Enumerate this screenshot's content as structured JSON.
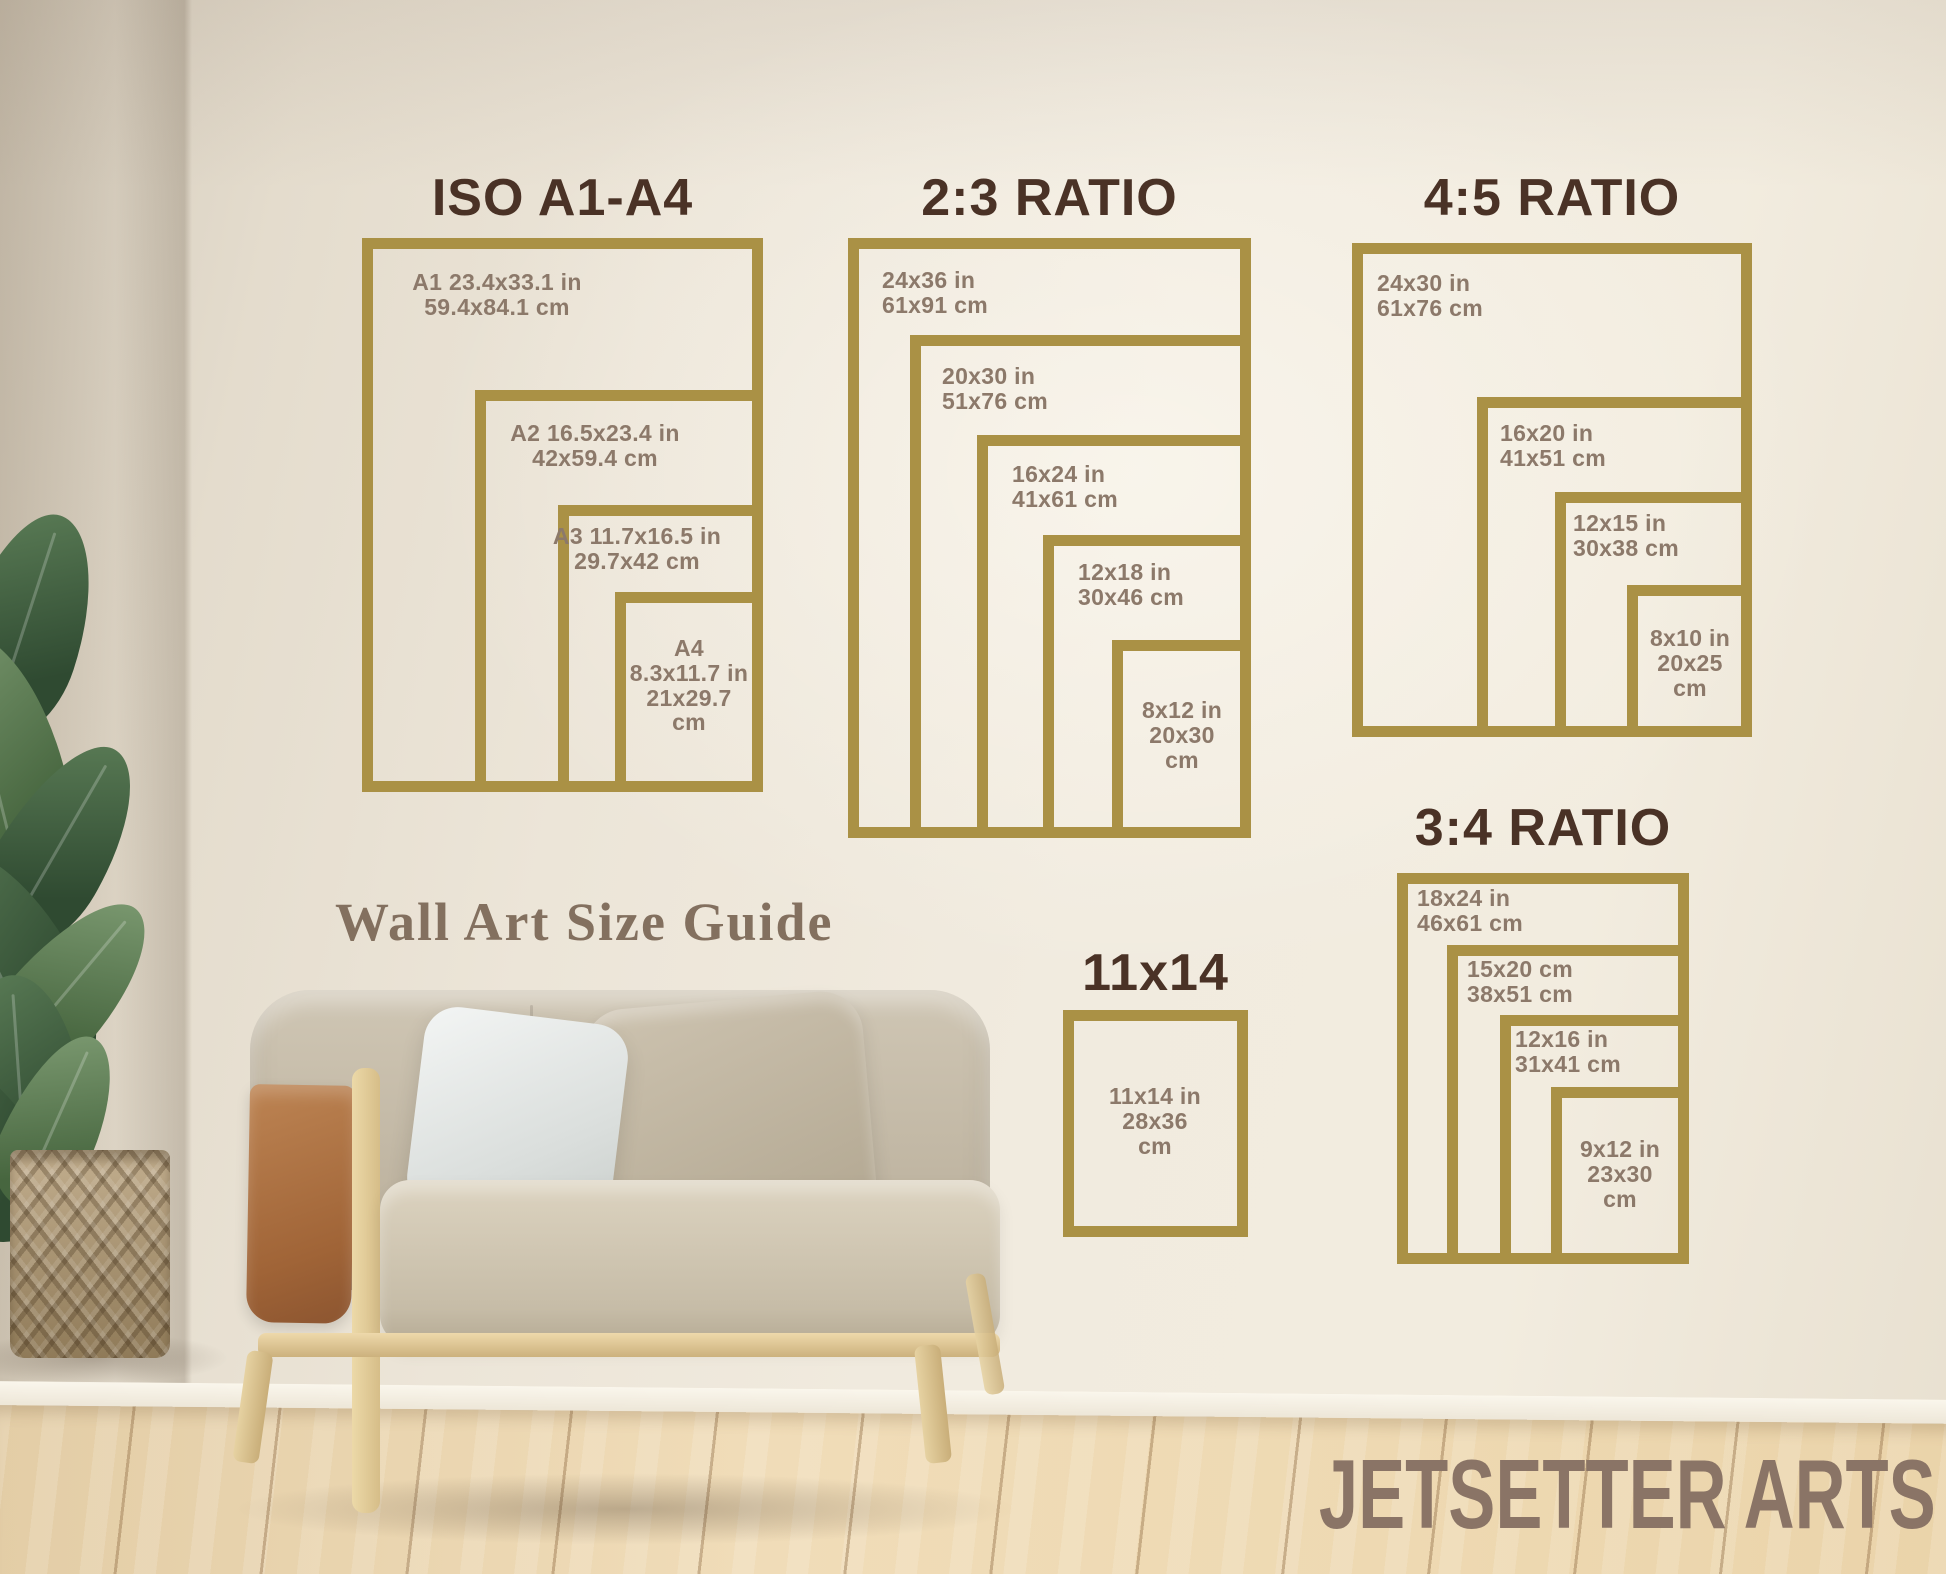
{
  "theme": {
    "frame_gold": "#aa9145",
    "title_brown": "#4a3226",
    "label_taupe": "#8c796a",
    "caption_color": "#83705f",
    "watermark_color": "#8a7466",
    "wall_color": "#ece5d8",
    "floor_wood": "#eed9b2"
  },
  "caption": "Wall Art Size Guide",
  "watermark": "JETSETTER ARTS",
  "groups": [
    {
      "id": "iso",
      "title": "ISO A1-A4",
      "title_y": 168,
      "frame": [
        362,
        238,
        763,
        792
      ],
      "sizes": [
        {
          "id": "a1",
          "lines": [
            "A1 23.4x33.1 in",
            "59.4x84.1 cm"
          ],
          "tl": [
            362,
            238
          ],
          "label": {
            "x": 497,
            "y": 270,
            "align": "center"
          }
        },
        {
          "id": "a2",
          "lines": [
            "A2 16.5x23.4 in",
            "42x59.4 cm"
          ],
          "tl": [
            475,
            390
          ],
          "label": {
            "x": 595,
            "y": 421,
            "align": "center"
          }
        },
        {
          "id": "a3",
          "lines": [
            "A3 11.7x16.5 in",
            "29.7x42 cm"
          ],
          "tl": [
            558,
            505
          ],
          "label": {
            "x": 637,
            "y": 524,
            "align": "center"
          }
        },
        {
          "id": "a4",
          "lines": [
            "A4",
            "8.3x11.7 in",
            "21x29.7",
            "cm"
          ],
          "tl": [
            615,
            592
          ],
          "label": {
            "x": 689,
            "y": 636,
            "align": "center"
          }
        }
      ]
    },
    {
      "id": "ratio-2-3",
      "title": "2:3 RATIO",
      "title_y": 168,
      "frame": [
        848,
        238,
        1251,
        838
      ],
      "sizes": [
        {
          "id": "24x36",
          "lines": [
            "24x36 in",
            "61x91 cm"
          ],
          "tl": [
            848,
            238
          ],
          "label": {
            "x": 882,
            "y": 268,
            "align": "left"
          }
        },
        {
          "id": "20x30",
          "lines": [
            "20x30 in",
            "51x76 cm"
          ],
          "tl": [
            910,
            335
          ],
          "label": {
            "x": 942,
            "y": 364,
            "align": "left"
          }
        },
        {
          "id": "16x24",
          "lines": [
            "16x24 in",
            "41x61 cm"
          ],
          "tl": [
            977,
            435
          ],
          "label": {
            "x": 1012,
            "y": 462,
            "align": "left"
          }
        },
        {
          "id": "12x18",
          "lines": [
            "12x18 in",
            "30x46 cm"
          ],
          "tl": [
            1043,
            535
          ],
          "label": {
            "x": 1078,
            "y": 560,
            "align": "left"
          }
        },
        {
          "id": "8x12",
          "lines": [
            "8x12 in",
            "20x30",
            "cm"
          ],
          "tl": [
            1112,
            640
          ],
          "label": {
            "x": 1182,
            "y": 698,
            "align": "center"
          }
        }
      ]
    },
    {
      "id": "ratio-4-5",
      "title": "4:5 RATIO",
      "title_y": 168,
      "frame": [
        1352,
        243,
        1752,
        737
      ],
      "sizes": [
        {
          "id": "24x30",
          "lines": [
            "24x30 in",
            "61x76 cm"
          ],
          "tl": [
            1352,
            243
          ],
          "label": {
            "x": 1377,
            "y": 271,
            "align": "left"
          }
        },
        {
          "id": "16x20",
          "lines": [
            "16x20 in",
            "41x51 cm"
          ],
          "tl": [
            1477,
            397
          ],
          "label": {
            "x": 1500,
            "y": 421,
            "align": "left"
          }
        },
        {
          "id": "12x15",
          "lines": [
            "12x15 in",
            "30x38 cm"
          ],
          "tl": [
            1555,
            492
          ],
          "label": {
            "x": 1573,
            "y": 511,
            "align": "left"
          }
        },
        {
          "id": "8x10",
          "lines": [
            "8x10 in",
            "20x25",
            "cm"
          ],
          "tl": [
            1627,
            585
          ],
          "label": {
            "x": 1690,
            "y": 626,
            "align": "center"
          }
        }
      ]
    },
    {
      "id": "ratio-3-4",
      "title": "3:4 RATIO",
      "title_y": 798,
      "frame": [
        1397,
        873,
        1689,
        1264
      ],
      "sizes": [
        {
          "id": "18x24",
          "lines": [
            "18x24 in",
            "46x61 cm"
          ],
          "tl": [
            1397,
            873
          ],
          "label": {
            "x": 1417,
            "y": 886,
            "align": "left"
          }
        },
        {
          "id": "15x20",
          "lines": [
            "15x20 cm",
            "38x51 cm"
          ],
          "tl": [
            1447,
            945
          ],
          "label": {
            "x": 1467,
            "y": 957,
            "align": "left"
          }
        },
        {
          "id": "12x16",
          "lines": [
            "12x16 in",
            "31x41 cm"
          ],
          "tl": [
            1500,
            1015
          ],
          "label": {
            "x": 1515,
            "y": 1027,
            "align": "left"
          }
        },
        {
          "id": "9x12",
          "lines": [
            "9x12 in",
            "23x30",
            "cm"
          ],
          "tl": [
            1551,
            1087
          ],
          "label": {
            "x": 1620,
            "y": 1137,
            "align": "center"
          }
        }
      ]
    },
    {
      "id": "size-11x14",
      "title": "11x14",
      "title_y": 943,
      "frame": [
        1063,
        1010,
        1248,
        1237
      ],
      "sizes": [
        {
          "id": "11x14",
          "lines": [
            "11x14 in",
            "28x36",
            "cm"
          ],
          "tl": [
            1063,
            1010
          ],
          "label": {
            "x": 1155,
            "y": 1084,
            "align": "center"
          }
        }
      ]
    }
  ]
}
